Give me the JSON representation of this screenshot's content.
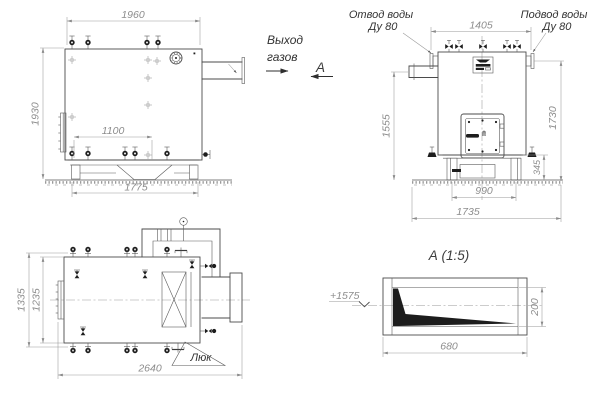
{
  "front_view": {
    "dim_top": "1960",
    "dim_left": "1930",
    "dim_inner": "1100",
    "dim_bottom": "1775"
  },
  "gas_outlet_label": {
    "line1": "Выход",
    "line2": "газов"
  },
  "section_arrow_label": "А",
  "side_view": {
    "water_outlet": {
      "line1": "Отвод воды",
      "line2": "Ду 80"
    },
    "water_supply": {
      "line1": "Подвод воды",
      "line2": "Ду 80"
    },
    "dim_top": "1405",
    "dim_left": "1555",
    "dim_right": "1730",
    "dim_base_width": "990",
    "dim_overall_width": "1735",
    "dim_base_height": "345"
  },
  "top_view": {
    "dim_left_outer": "1335",
    "dim_left_inner": "1235",
    "dim_length": "2640",
    "hatch_label": "Люк"
  },
  "section_a": {
    "title": "А  (1:5)",
    "elevation_mark": "+1575",
    "dim_width": "680",
    "dim_height": "200"
  },
  "colors": {
    "background": "#ffffff",
    "line": "#4b4b4b",
    "dimension": "#8d8d8d",
    "label": "#333333",
    "fill_dark": "#1d1d1d"
  }
}
